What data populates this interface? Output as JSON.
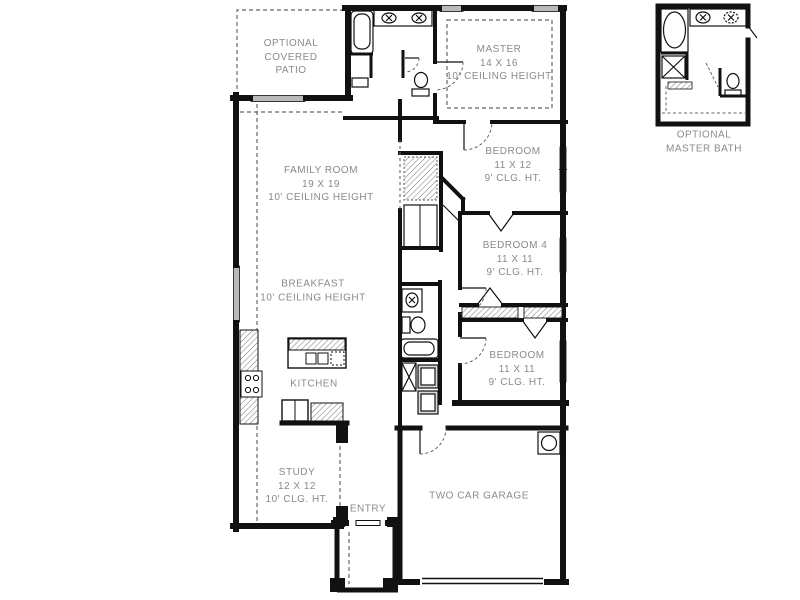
{
  "document": {
    "type": "residential-floor-plan",
    "colors": {
      "wall": "#111111",
      "label_text": "#8a8a8a",
      "window_fill": "#b9b9b9",
      "background": "#ffffff"
    }
  },
  "rooms": [
    {
      "id": "optional-covered-patio",
      "label": "OPTIONAL\nCOVERED\nPATIO"
    },
    {
      "id": "master-bedroom",
      "label": "MASTER\n14 X 16\n10' CEILING HEIGHT"
    },
    {
      "id": "bedroom-2",
      "label": "BEDROOM\n11 X 12\n9' CLG. HT."
    },
    {
      "id": "bedroom-4",
      "label": "BEDROOM 4\n11 X 11\n9' CLG. HT."
    },
    {
      "id": "bedroom-3",
      "label": "BEDROOM\n11 X 11\n9' CLG. HT."
    },
    {
      "id": "family-room",
      "label": "FAMILY ROOM\n19 X 19\n10' CEILING HEIGHT"
    },
    {
      "id": "breakfast",
      "label": "BREAKFAST\n10' CEILING HEIGHT"
    },
    {
      "id": "kitchen",
      "label": "KITCHEN"
    },
    {
      "id": "study",
      "label": "STUDY\n12 X 12\n10' CLG. HT."
    },
    {
      "id": "entry",
      "label": "ENTRY"
    },
    {
      "id": "two-car-garage",
      "label": "TWO CAR GARAGE"
    },
    {
      "id": "optional-master-bath-inset",
      "label": "OPTIONAL\nMASTER BATH"
    }
  ],
  "fixtures": [
    "bathtub",
    "double-vanity-sinks",
    "toilet",
    "shower",
    "linen-shelves",
    "coat-closet",
    "kitchen-island",
    "double-sink",
    "dishwasher",
    "range-cooktop",
    "refrigerator",
    "pantry-counter",
    "washer-dryer",
    "water-heater",
    "tray-ceiling-dashed",
    "windows",
    "door-swings",
    "garage-door",
    "porch-columns"
  ]
}
